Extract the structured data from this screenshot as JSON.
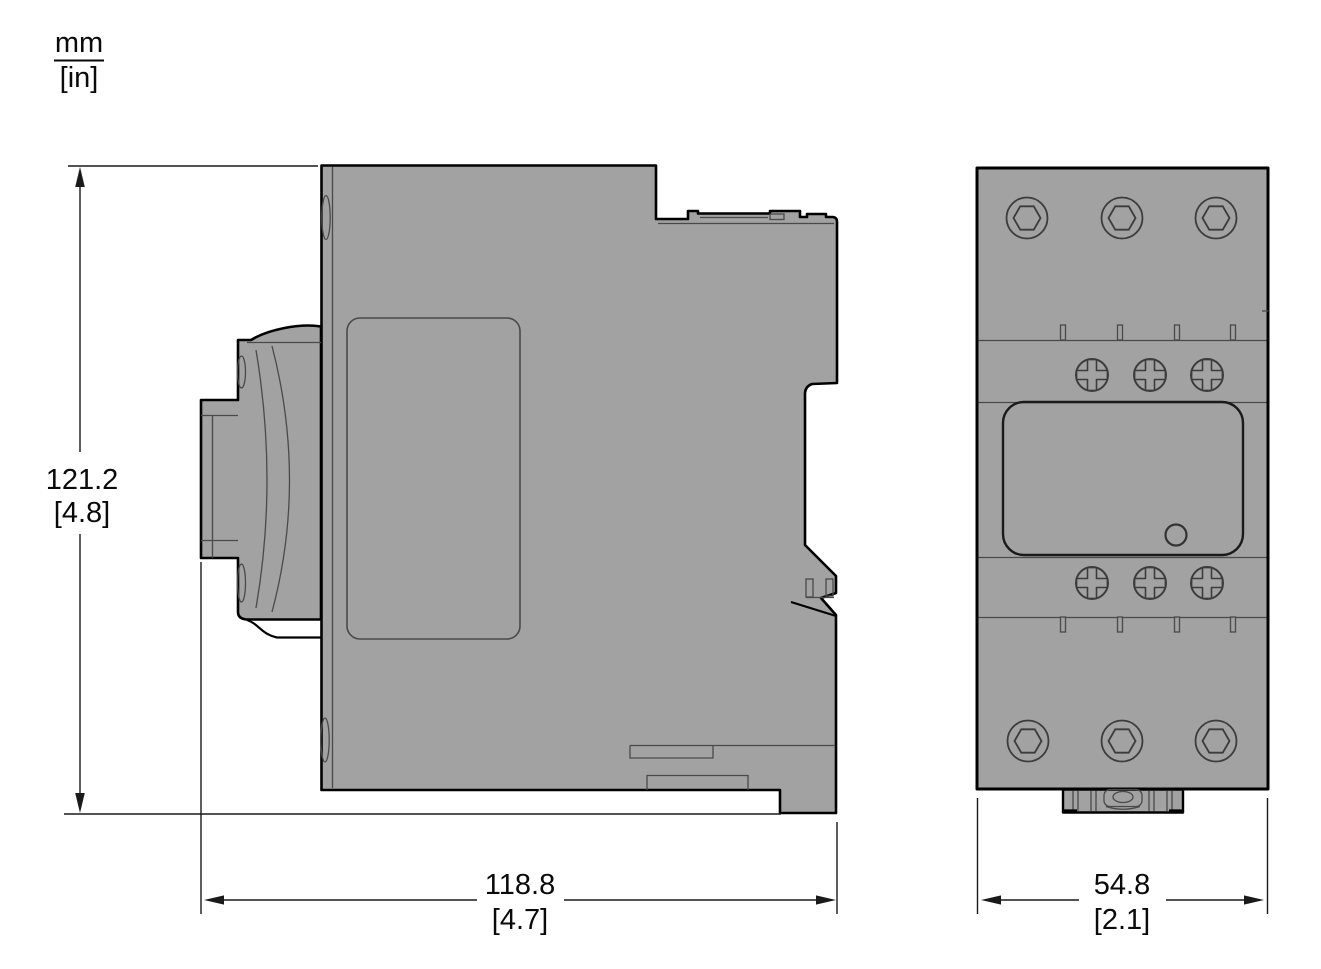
{
  "units_legend": {
    "primary": "mm",
    "secondary": "[in]"
  },
  "dimensions": {
    "side_height": {
      "mm": "121.2",
      "inches": "[4.8]"
    },
    "side_width": {
      "mm": "118.8",
      "inches": "[4.7]"
    },
    "front_width": {
      "mm": "54.8",
      "inches": "[2.1]"
    }
  },
  "colors": {
    "background": "#ffffff",
    "device_fill": "#a2a2a2",
    "outline": "#000000",
    "detail_line": "#4a4a4a",
    "screw_line": "#3c3c3c",
    "dimension_line": "#1a1a1a",
    "text": "#0a0a0a"
  }
}
